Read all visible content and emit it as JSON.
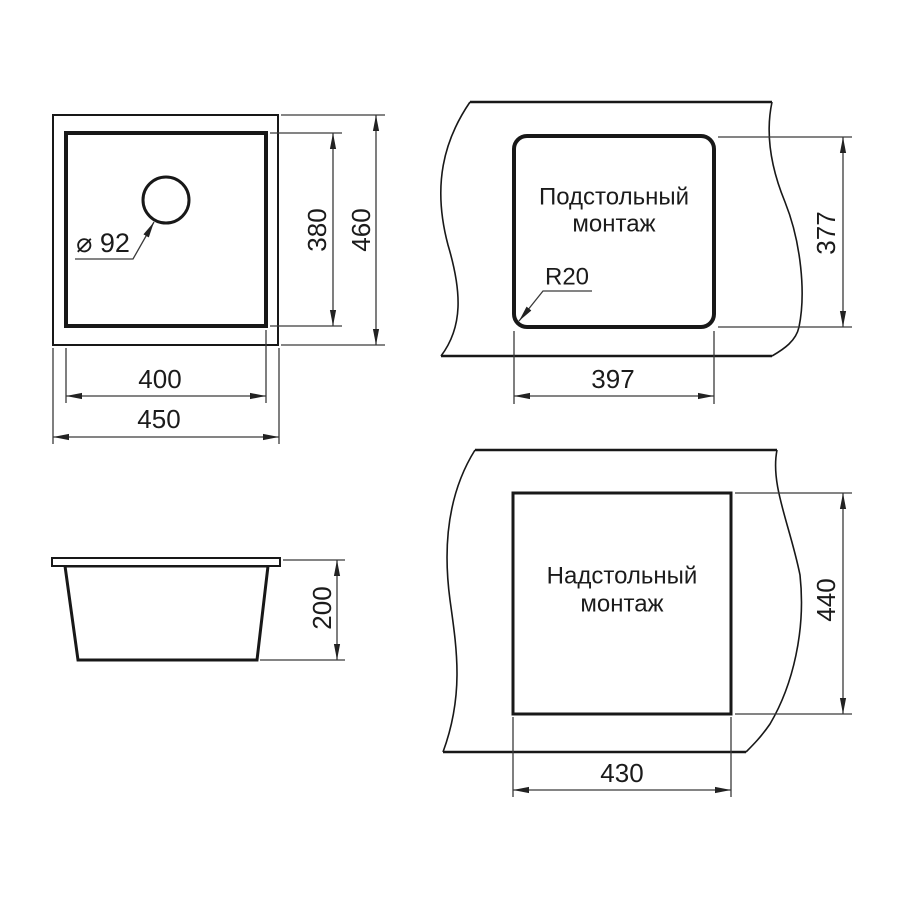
{
  "drawing_title": "Sink mounting dimensions drawing",
  "views": {
    "plan": {
      "drain_diameter": "⌀ 92",
      "inner_width": "400",
      "outer_width": "450",
      "inner_depth": "380",
      "outer_depth": "460"
    },
    "undermount": {
      "title_line1": "Подстольный",
      "title_line2": "монтаж",
      "corner_radius": "R20",
      "cutout_width": "397",
      "cutout_height": "377"
    },
    "side": {
      "bowl_height": "200"
    },
    "topmount": {
      "title_line1": "Надстольный",
      "title_line2": "монтаж",
      "cutout_width": "430",
      "cutout_height": "440"
    }
  },
  "colors": {
    "background": "#ffffff",
    "main_line": "#181818",
    "dimension_line": "#3a3a3a",
    "text": "#1b1b1b"
  }
}
